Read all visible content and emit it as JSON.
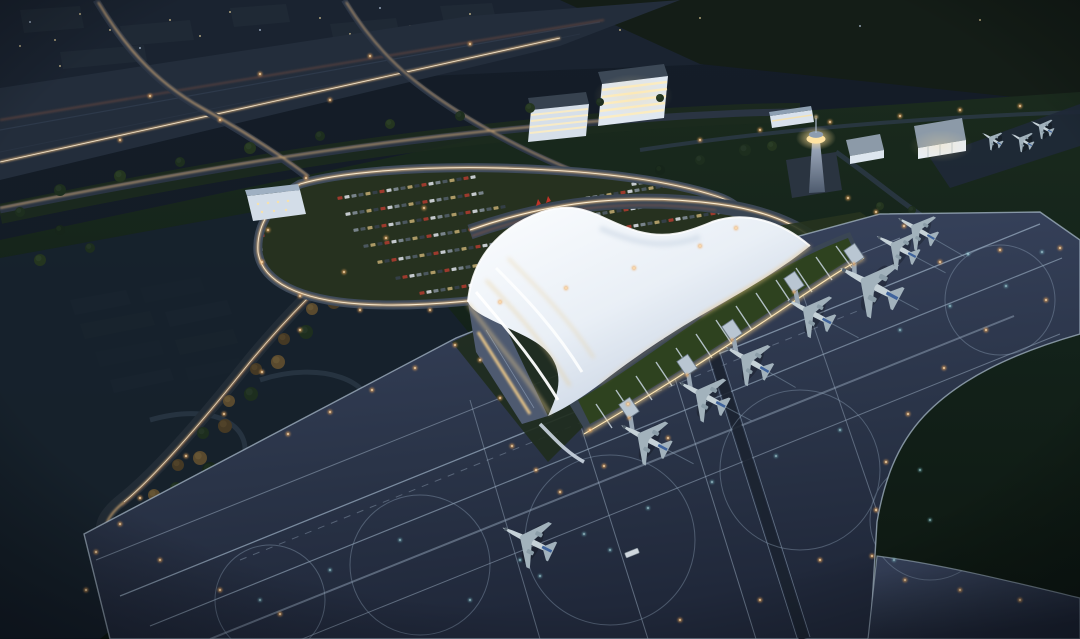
{
  "meta": {
    "kind": "architectural-night-rendering",
    "subject": "aerial dusk view of an airport terminal with wing-shaped white roof, apron, taxiways and parked aircraft",
    "width": 1080,
    "height": 639
  },
  "palette": {
    "bg": "#121a23",
    "city": "#1a2330",
    "field_green": "#182619",
    "airfield_green": "#0d1711",
    "park": "#17222e",
    "path": "#2b3846",
    "road": "#2b3545",
    "expressway": "#232d3b",
    "trail_warm": "#eebd7e",
    "trail_core": "#fff3da",
    "trail_red": "#b06040",
    "apron_top": "#36415a",
    "apron_bottom": "#20283a",
    "apron_line": "#9db0c4",
    "service_strip": "#1b2330",
    "roof_light": "#fafcfe",
    "roof_shade": "#b6c4d8",
    "glow_warm": "#f2cc86",
    "concourse": "#3a4654",
    "green_roof": "#2e421f",
    "beam": "#c7d4e0",
    "facade_glass": "#4e5a70",
    "facade_light": "#f6cf8a",
    "tower_cab": "#ffe3a2",
    "building_face": "#dfe7f0",
    "window_warm": "#ffeec0",
    "aircraft_body": "#c6d2d8",
    "aircraft_wing": "#a2b2bc",
    "aircraft_fin": "#3f639c",
    "light_amber": "#f0a85a",
    "light_cyan": "#8fe0e8",
    "light_city": "#f0d9a0",
    "lawn": "#26311f",
    "flag_red": "#c03428"
  },
  "aircraft": {
    "gates": [
      {
        "x": 645,
        "y": 438,
        "r": -62,
        "s": 1.0,
        "bridge": true
      },
      {
        "x": 703,
        "y": 395,
        "r": -62,
        "s": 1.0,
        "bridge": true
      },
      {
        "x": 748,
        "y": 360,
        "r": -60,
        "s": 0.95,
        "bridge": true
      },
      {
        "x": 810,
        "y": 312,
        "r": -62,
        "s": 0.95,
        "bridge": true
      },
      {
        "x": 870,
        "y": 284,
        "r": -62,
        "s": 1.25,
        "bridge": true
      },
      {
        "x": 897,
        "y": 247,
        "r": -62,
        "s": 0.85,
        "bridge": false
      },
      {
        "x": 917,
        "y": 229,
        "r": -60,
        "s": 0.8,
        "bridge": false
      }
    ],
    "small": [
      {
        "x": 1042,
        "y": 127,
        "r": -62,
        "s": 0.45
      },
      {
        "x": 1022,
        "y": 140,
        "r": -60,
        "s": 0.45
      },
      {
        "x": 992,
        "y": 139,
        "r": -58,
        "s": 0.42
      }
    ],
    "taxiing": [
      {
        "x": 528,
        "y": 540,
        "r": -64,
        "s": 1.05
      }
    ]
  },
  "vehicles": {
    "bus": {
      "x": 632,
      "y": 553,
      "r": -22
    }
  },
  "cars": {
    "colors": [
      "#a33b2e",
      "#cdd3d8",
      "#7c8890",
      "#4d5a62",
      "#b3a06a",
      "#35404a"
    ],
    "step_x": 7.0,
    "step_y": -1.1,
    "rows": [
      {
        "x": 340,
        "y": 198,
        "n": 20
      },
      {
        "x": 348,
        "y": 214,
        "n": 20
      },
      {
        "x": 356,
        "y": 230,
        "n": 22
      },
      {
        "x": 366,
        "y": 246,
        "n": 24
      },
      {
        "x": 380,
        "y": 262,
        "n": 26
      },
      {
        "x": 398,
        "y": 278,
        "n": 25
      },
      {
        "x": 422,
        "y": 293,
        "n": 21
      },
      {
        "x": 588,
        "y": 198,
        "n": 17
      },
      {
        "x": 598,
        "y": 214,
        "n": 19
      },
      {
        "x": 608,
        "y": 230,
        "n": 18
      },
      {
        "x": 620,
        "y": 246,
        "n": 16
      },
      {
        "x": 634,
        "y": 261,
        "n": 13
      },
      {
        "x": 622,
        "y": 170,
        "n": 13
      },
      {
        "x": 634,
        "y": 184,
        "n": 13
      },
      {
        "x": 234,
        "y": 240,
        "n": 5
      },
      {
        "x": 232,
        "y": 254,
        "n": 5
      },
      {
        "x": 230,
        "y": 268,
        "n": 5
      }
    ]
  },
  "trees": {
    "colors": [
      "#16251a",
      "#1d2e1e",
      "#24351f",
      "#453924",
      "#5a4a2e"
    ],
    "highlights": [
      "#20301f",
      "#28392a",
      "#2e4129",
      "#55462c",
      "#6b5a38"
    ],
    "items": [
      [
        418,
        224,
        7,
        1
      ],
      [
        396,
        231,
        6,
        3
      ],
      [
        390,
        248,
        7,
        4
      ],
      [
        368,
        255,
        6,
        3
      ],
      [
        362,
        274,
        7,
        1
      ],
      [
        340,
        281,
        6,
        4
      ],
      [
        334,
        302,
        7,
        3
      ],
      [
        312,
        309,
        6,
        4
      ],
      [
        306,
        332,
        7,
        1
      ],
      [
        284,
        339,
        6,
        3
      ],
      [
        278,
        362,
        7,
        4
      ],
      [
        256,
        369,
        6,
        3
      ],
      [
        251,
        394,
        7,
        1
      ],
      [
        229,
        401,
        6,
        4
      ],
      [
        225,
        426,
        7,
        3
      ],
      [
        203,
        433,
        6,
        1
      ],
      [
        200,
        458,
        7,
        4
      ],
      [
        178,
        465,
        6,
        3
      ],
      [
        176,
        488,
        6,
        1
      ],
      [
        154,
        495,
        6,
        4
      ],
      [
        153,
        512,
        6,
        3
      ],
      [
        131,
        516,
        6,
        1
      ],
      [
        210,
        470,
        8,
        0
      ],
      [
        250,
        500,
        7,
        1
      ],
      [
        300,
        480,
        6,
        2
      ],
      [
        340,
        520,
        8,
        0
      ],
      [
        230,
        560,
        7,
        1
      ],
      [
        300,
        590,
        8,
        0
      ],
      [
        370,
        560,
        6,
        2
      ],
      [
        400,
        600,
        7,
        1
      ],
      [
        160,
        540,
        6,
        0
      ],
      [
        350,
        440,
        7,
        2
      ],
      [
        390,
        470,
        6,
        1
      ],
      [
        420,
        500,
        7,
        0
      ],
      [
        430,
        560,
        6,
        2
      ],
      [
        180,
        600,
        7,
        1
      ],
      [
        420,
        430,
        5,
        2
      ],
      [
        450,
        470,
        5,
        1
      ],
      [
        310,
        545,
        6,
        0
      ],
      [
        265,
        535,
        6,
        2
      ],
      [
        60,
        190,
        6,
        1
      ],
      [
        120,
        176,
        6,
        2
      ],
      [
        180,
        162,
        5,
        1
      ],
      [
        250,
        148,
        6,
        2
      ],
      [
        320,
        136,
        5,
        1
      ],
      [
        390,
        124,
        5,
        2
      ],
      [
        460,
        116,
        5,
        1
      ],
      [
        530,
        108,
        5,
        2
      ],
      [
        600,
        102,
        4,
        1
      ],
      [
        660,
        98,
        4,
        2
      ],
      [
        60,
        230,
        5,
        0
      ],
      [
        20,
        212,
        5,
        1
      ],
      [
        745,
        150,
        6,
        1
      ],
      [
        772,
        146,
        5,
        2
      ],
      [
        700,
        160,
        5,
        1
      ],
      [
        660,
        170,
        5,
        0
      ],
      [
        912,
        210,
        4,
        1
      ],
      [
        880,
        206,
        4,
        2
      ],
      [
        755,
        222,
        4,
        2
      ],
      [
        40,
        260,
        6,
        2
      ],
      [
        90,
        248,
        5,
        1
      ]
    ]
  },
  "jet_bridge": {
    "root_dx": -16,
    "root_dy": -30,
    "pier_w": 13,
    "pier_h": 17,
    "angle": -34
  },
  "lights": {
    "amber": [
      [
        306,
        178
      ],
      [
        268,
        230
      ],
      [
        262,
        262
      ],
      [
        300,
        296
      ],
      [
        360,
        310
      ],
      [
        430,
        310
      ],
      [
        500,
        302
      ],
      [
        566,
        288
      ],
      [
        634,
        268
      ],
      [
        700,
        246
      ],
      [
        736,
        228
      ],
      [
        424,
        208
      ],
      [
        386,
        238
      ],
      [
        344,
        272
      ],
      [
        300,
        330
      ],
      [
        262,
        372
      ],
      [
        224,
        414
      ],
      [
        186,
        456
      ],
      [
        140,
        498
      ],
      [
        120,
        524
      ],
      [
        160,
        560
      ],
      [
        220,
        590
      ],
      [
        280,
        614
      ],
      [
        96,
        552
      ],
      [
        86,
        590
      ],
      [
        480,
        360
      ],
      [
        500,
        398
      ],
      [
        512,
        446
      ],
      [
        536,
        470
      ],
      [
        560,
        492
      ],
      [
        455,
        345
      ],
      [
        415,
        368
      ],
      [
        372,
        390
      ],
      [
        330,
        412
      ],
      [
        288,
        434
      ],
      [
        940,
        262
      ],
      [
        1000,
        250
      ],
      [
        1060,
        248
      ],
      [
        1046,
        300
      ],
      [
        986,
        330
      ],
      [
        944,
        368
      ],
      [
        908,
        414
      ],
      [
        886,
        462
      ],
      [
        876,
        510
      ],
      [
        872,
        556
      ],
      [
        905,
        580
      ],
      [
        960,
        590
      ],
      [
        1020,
        600
      ],
      [
        150,
        96
      ],
      [
        260,
        74
      ],
      [
        370,
        56
      ],
      [
        470,
        44
      ],
      [
        120,
        140
      ],
      [
        220,
        120
      ],
      [
        330,
        100
      ],
      [
        700,
        140
      ],
      [
        760,
        130
      ],
      [
        830,
        122
      ],
      [
        900,
        116
      ],
      [
        960,
        110
      ],
      [
        1020,
        106
      ],
      [
        848,
        198
      ],
      [
        876,
        212
      ],
      [
        904,
        226
      ],
      [
        668,
        438
      ],
      [
        628,
        404
      ],
      [
        590,
        430
      ],
      [
        604,
        466
      ],
      [
        760,
        600
      ],
      [
        680,
        620
      ],
      [
        820,
        560
      ]
    ],
    "cyan": [
      [
        520,
        560
      ],
      [
        584,
        534
      ],
      [
        648,
        508
      ],
      [
        712,
        482
      ],
      [
        776,
        456
      ],
      [
        840,
        430
      ],
      [
        470,
        600
      ],
      [
        540,
        576
      ],
      [
        610,
        550
      ],
      [
        900,
        330
      ],
      [
        950,
        306
      ],
      [
        1006,
        286
      ],
      [
        920,
        470
      ],
      [
        930,
        520
      ],
      [
        894,
        560
      ],
      [
        260,
        600
      ],
      [
        330,
        570
      ],
      [
        400,
        540
      ],
      [
        1042,
        252
      ],
      [
        968,
        254
      ]
    ],
    "city": [
      [
        30,
        22
      ],
      [
        55,
        40
      ],
      [
        80,
        14
      ],
      [
        110,
        30
      ],
      [
        140,
        48
      ],
      [
        170,
        20
      ],
      [
        200,
        36
      ],
      [
        230,
        12
      ],
      [
        260,
        30
      ],
      [
        290,
        46
      ],
      [
        320,
        18
      ],
      [
        350,
        34
      ],
      [
        380,
        8
      ],
      [
        410,
        26
      ],
      [
        440,
        40
      ],
      [
        470,
        14
      ],
      [
        500,
        28
      ],
      [
        60,
        66
      ],
      [
        160,
        70
      ],
      [
        260,
        62
      ],
      [
        360,
        58
      ],
      [
        460,
        50
      ],
      [
        20,
        46
      ],
      [
        240,
        80
      ],
      [
        130,
        84
      ],
      [
        560,
        44
      ],
      [
        620,
        30
      ],
      [
        700,
        18
      ],
      [
        860,
        26
      ],
      [
        980,
        20
      ]
    ]
  }
}
